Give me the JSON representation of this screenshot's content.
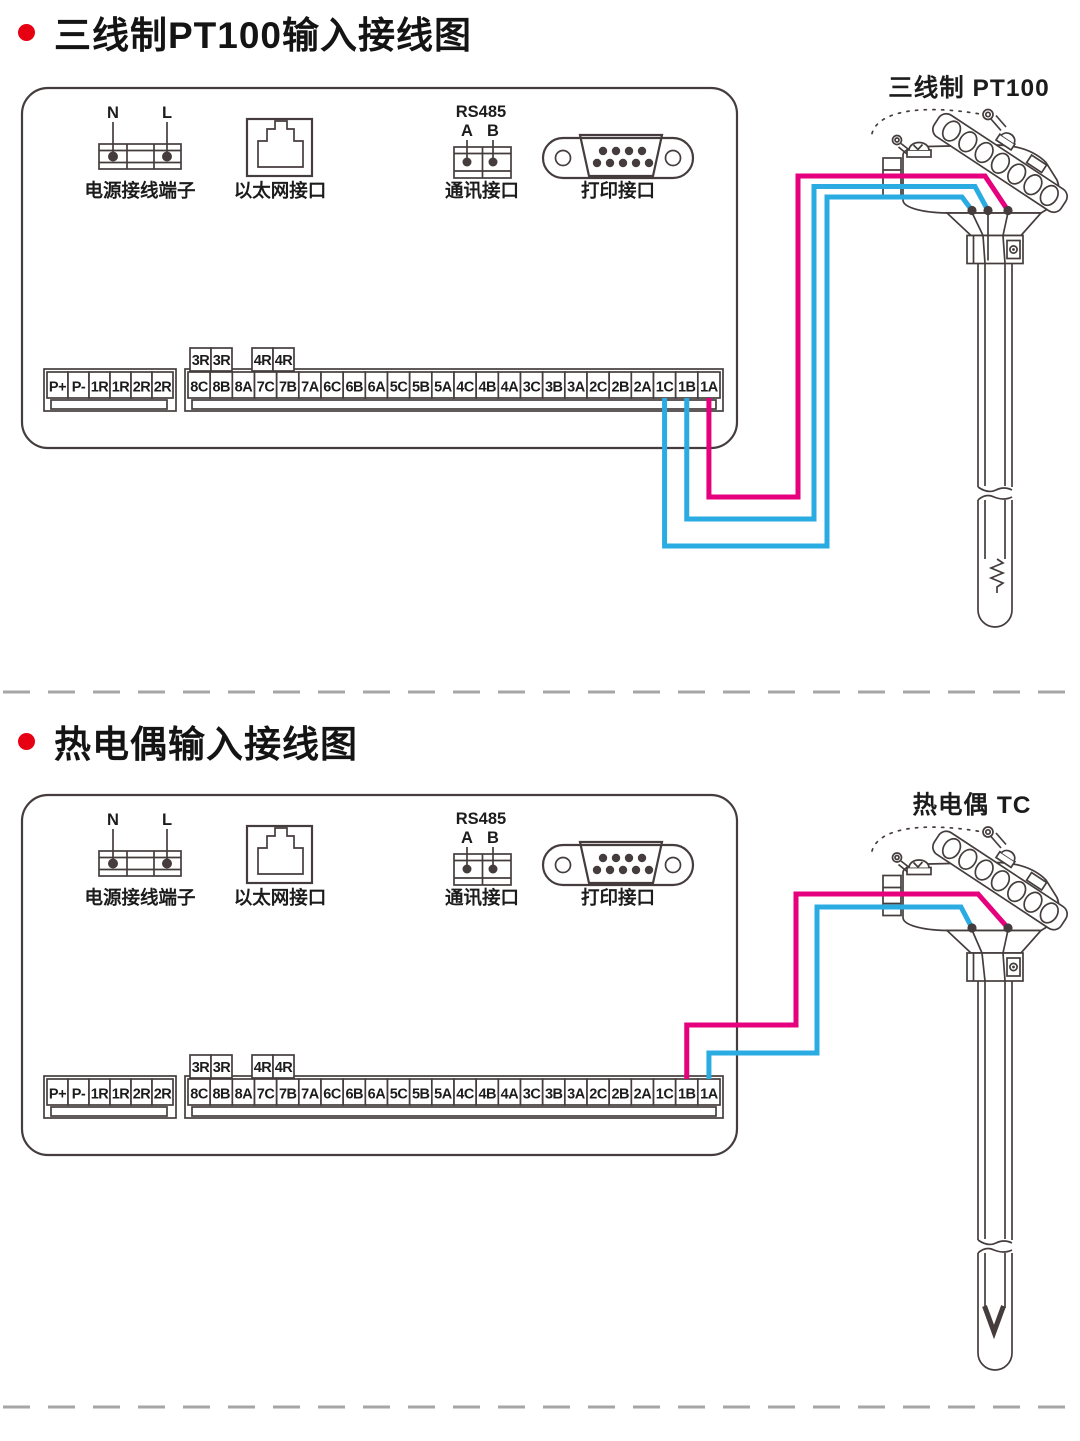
{
  "colors": {
    "line": "#453d3d",
    "magenta": "#e6007e",
    "blue": "#2aace3",
    "bullet_red": "#e60012",
    "divider": "#a6a6a6"
  },
  "sections": [
    {
      "title": "三线制PT100输入接线图",
      "sensor_label": "三线制 PT100",
      "sensor_type": "pt100",
      "wires": [
        {
          "terminal": "1C",
          "color": "blue",
          "pin": 0
        },
        {
          "terminal": "1B",
          "color": "blue",
          "pin": 1
        },
        {
          "terminal": "1A",
          "color": "magenta",
          "pin": 2
        }
      ]
    },
    {
      "title": "热电偶输入接线图",
      "sensor_label": "热电偶 TC",
      "sensor_type": "tc",
      "wires": [
        {
          "terminal": "1B",
          "color": "magenta",
          "pin": 1
        },
        {
          "terminal": "1A",
          "color": "blue",
          "pin": 0
        }
      ]
    }
  ],
  "panel": {
    "power": {
      "label": "电源接线端子",
      "pins": [
        "N",
        "L"
      ]
    },
    "ethernet": {
      "label": "以太网接口"
    },
    "rs485": {
      "title": "RS485",
      "pins": [
        "A",
        "B"
      ],
      "label": "通讯接口"
    },
    "printer": {
      "label": "打印接口"
    },
    "left_terminals": [
      "P+",
      "P-",
      "1R",
      "1R",
      "2R",
      "2R"
    ],
    "relay_groups": [
      [
        "3R",
        "3R"
      ],
      [
        "4R",
        "4R"
      ]
    ],
    "main_terminals": [
      "8C",
      "8B",
      "8A",
      "7C",
      "7B",
      "7A",
      "6C",
      "6B",
      "6A",
      "5C",
      "5B",
      "5A",
      "4C",
      "4B",
      "4A",
      "3C",
      "3B",
      "3A",
      "2C",
      "2B",
      "2A",
      "1C",
      "1B",
      "1A"
    ]
  }
}
